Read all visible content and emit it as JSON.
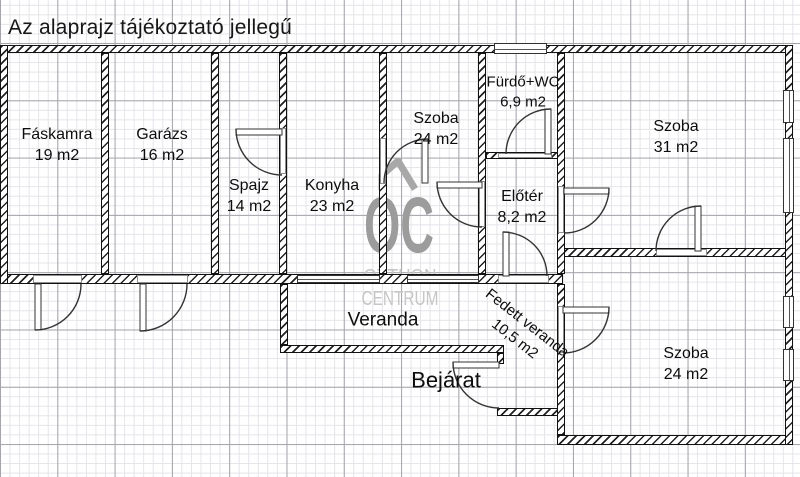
{
  "header": {
    "title": "Az alaprajz tájékoztató jellegű"
  },
  "watermark": {
    "line1": "OC",
    "line2": "OTTHON",
    "line3": "CENTRUM",
    "icon": "roof-icon",
    "color_main": "#9c9c9c",
    "color_sub": "#c6c6c6",
    "color_icon": "#a8a8a8"
  },
  "plan": {
    "colors": {
      "wall": "#111111",
      "grid_minor": "#e4e4e9",
      "grid_major": "#a4a4ab",
      "label": "#0d0d0d",
      "door_stroke": "#333333",
      "sill_border": "#8f8f8f"
    },
    "rooms": [
      {
        "name": "Fáskamra",
        "area": "19 m2",
        "cx": 57,
        "cy": 146,
        "fs": 16
      },
      {
        "name": "Garázs",
        "area": "16 m2",
        "cx": 162,
        "cy": 146,
        "fs": 16
      },
      {
        "name": "Spajz",
        "area": "14 m2",
        "cx": 249,
        "cy": 197,
        "fs": 16
      },
      {
        "name": "Konyha",
        "area": "23 m2",
        "cx": 332,
        "cy": 197,
        "fs": 16
      },
      {
        "name": "Szoba",
        "area": "24 m2",
        "cx": 436,
        "cy": 130,
        "fs": 16
      },
      {
        "name": "Fürdő+WC",
        "area": "6,9 m2",
        "cx": 523,
        "cy": 92,
        "fs": 15
      },
      {
        "name": "Előtér",
        "area": "8,2 m2",
        "cx": 522,
        "cy": 208,
        "fs": 16
      },
      {
        "name": "Szoba",
        "area": "31 m2",
        "cx": 676,
        "cy": 138,
        "fs": 16
      },
      {
        "name": "Szoba",
        "area": "24 m2",
        "cx": 686,
        "cy": 365,
        "fs": 16
      },
      {
        "name": "Veranda",
        "area": "",
        "cx": 383,
        "cy": 321,
        "fs": 19
      },
      {
        "name": "Bejárat",
        "area": "",
        "cx": 446,
        "cy": 381,
        "fs": 22
      },
      {
        "name": "Fedett veranda",
        "area": "10,5 m2",
        "cx": 521,
        "cy": 331,
        "fs": 15,
        "rot": 38
      }
    ],
    "walls": [
      {
        "x": 4,
        "y": 45,
        "w": 789,
        "h": 8
      },
      {
        "x": 486,
        "y": 152,
        "w": 72,
        "h": 7
      },
      {
        "x": 557,
        "y": 248,
        "w": 236,
        "h": 9
      },
      {
        "x": 0,
        "y": 274,
        "w": 563,
        "h": 10
      },
      {
        "x": 280,
        "y": 345,
        "w": 224,
        "h": 8
      },
      {
        "x": 497,
        "y": 408,
        "w": 68,
        "h": 8
      },
      {
        "x": 557,
        "y": 435,
        "w": 236,
        "h": 10
      },
      {
        "x": 0,
        "y": 45,
        "w": 8,
        "h": 239
      },
      {
        "x": 101,
        "y": 53,
        "w": 8,
        "h": 221
      },
      {
        "x": 211,
        "y": 53,
        "w": 8,
        "h": 221
      },
      {
        "x": 279,
        "y": 53,
        "w": 8,
        "h": 221
      },
      {
        "x": 379,
        "y": 53,
        "w": 8,
        "h": 221
      },
      {
        "x": 478,
        "y": 53,
        "w": 8,
        "h": 221
      },
      {
        "x": 557,
        "y": 53,
        "w": 8,
        "h": 221
      },
      {
        "x": 557,
        "y": 284,
        "w": 8,
        "h": 151
      },
      {
        "x": 280,
        "y": 284,
        "w": 8,
        "h": 61
      },
      {
        "x": 497,
        "y": 353,
        "w": 7,
        "h": 11
      },
      {
        "x": 785,
        "y": 45,
        "w": 8,
        "h": 400
      }
    ],
    "sills": [
      {
        "x": 33,
        "y": 275,
        "w": 49,
        "h": 8
      },
      {
        "x": 137,
        "y": 275,
        "w": 51,
        "h": 8
      },
      {
        "x": 498,
        "y": 275,
        "w": 51,
        "h": 8
      },
      {
        "x": 280,
        "y": 128,
        "w": 6,
        "h": 46
      },
      {
        "x": 380,
        "y": 138,
        "w": 6,
        "h": 46
      },
      {
        "x": 479,
        "y": 181,
        "w": 6,
        "h": 46
      },
      {
        "x": 498,
        "y": 153,
        "w": 54,
        "h": 5
      },
      {
        "x": 558,
        "y": 186,
        "w": 6,
        "h": 47
      },
      {
        "x": 656,
        "y": 249,
        "w": 51,
        "h": 7
      },
      {
        "x": 558,
        "y": 306,
        "w": 6,
        "h": 47
      }
    ],
    "windows": [
      {
        "x": 494,
        "y": 43,
        "w": 53,
        "h": 11,
        "o": "h"
      },
      {
        "x": 297,
        "y": 275,
        "w": 83,
        "h": 8,
        "o": "h"
      },
      {
        "x": 407,
        "y": 275,
        "w": 72,
        "h": 8,
        "o": "h"
      },
      {
        "x": 783,
        "y": 90,
        "w": 11,
        "h": 33,
        "o": "v"
      },
      {
        "x": 783,
        "y": 138,
        "w": 11,
        "h": 75,
        "o": "v"
      },
      {
        "x": 783,
        "y": 296,
        "w": 11,
        "h": 32,
        "o": "v"
      },
      {
        "x": 783,
        "y": 349,
        "w": 11,
        "h": 32,
        "o": "v"
      }
    ],
    "doors": [
      {
        "hx": 35,
        "hy": 284,
        "r": 46,
        "a1": 90,
        "a2": 0,
        "sweep": 0
      },
      {
        "hx": 140,
        "hy": 284,
        "r": 47,
        "a1": 90,
        "a2": 0,
        "sweep": 0
      },
      {
        "hx": 282,
        "hy": 129,
        "r": 46,
        "a1": 180,
        "a2": 90,
        "sweep": 0
      },
      {
        "hx": 428,
        "hy": 183,
        "r": 44,
        "a1": 270,
        "a2": 180,
        "sweep": 0
      },
      {
        "hx": 482,
        "hy": 182,
        "r": 45,
        "a1": 180,
        "a2": 90,
        "sweep": 0
      },
      {
        "hx": 551,
        "hy": 154,
        "r": 45,
        "a1": 270,
        "a2": 180,
        "sweep": 0
      },
      {
        "hx": 564,
        "hy": 188,
        "r": 45,
        "a1": 0,
        "a2": 90,
        "sweep": 1
      },
      {
        "hx": 701,
        "hy": 251,
        "r": 45,
        "a1": 270,
        "a2": 180,
        "sweep": 0
      },
      {
        "hx": 563,
        "hy": 307,
        "r": 46,
        "a1": 0,
        "a2": 90,
        "sweep": 1
      },
      {
        "hx": 499,
        "hy": 362,
        "r": 46,
        "a1": 180,
        "a2": 90,
        "sweep": 0
      },
      {
        "hx": 503,
        "hy": 276,
        "r": 44,
        "a1": 270,
        "a2": 0,
        "sweep": 1
      }
    ]
  }
}
